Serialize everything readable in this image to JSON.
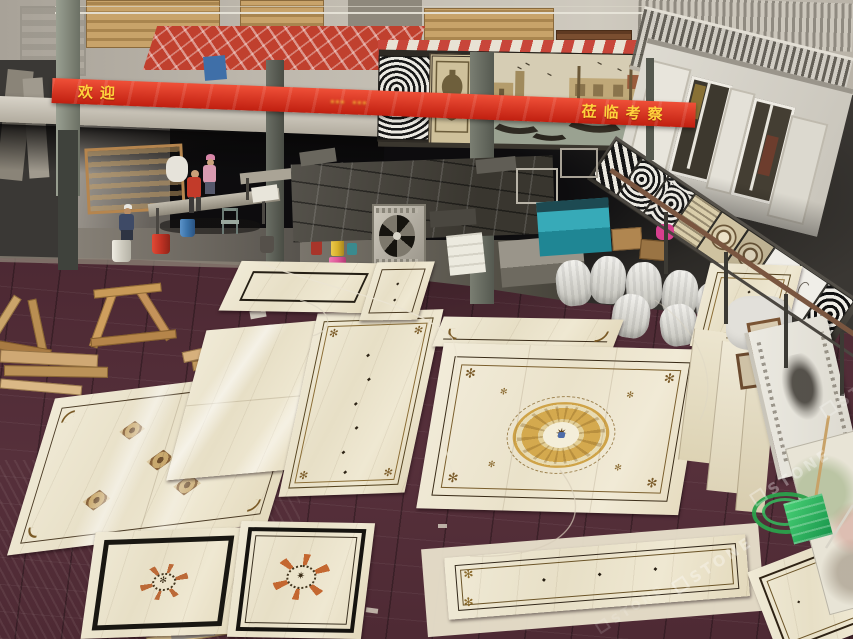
{
  "banner": {
    "text_start": "欢迎",
    "text_middle": "⋯⋯",
    "text_end": "莅临考察",
    "bg_color": "#dd2f1b",
    "text_color": "#ffd23c"
  },
  "warning_sign": {
    "glyph": "⚠",
    "bg_color": "#e7c520"
  },
  "watermark": {
    "text": "STONE",
    "color": "rgba(255,255,255,0.32)"
  },
  "palette": {
    "showroom_floor_maroon": "#4a2731",
    "marble_cream": "#ece4cc",
    "medallion_gold": "#d2a84e",
    "border_brown": "#55431f",
    "machine_teal": "#2fa3b2",
    "hose_green": "#2ea14f",
    "bag_magenta": "#d63f8e",
    "upper_floor_red": "#c0402e",
    "wood_tan": "#c89a58",
    "workshop_gray": "#8e897f"
  }
}
